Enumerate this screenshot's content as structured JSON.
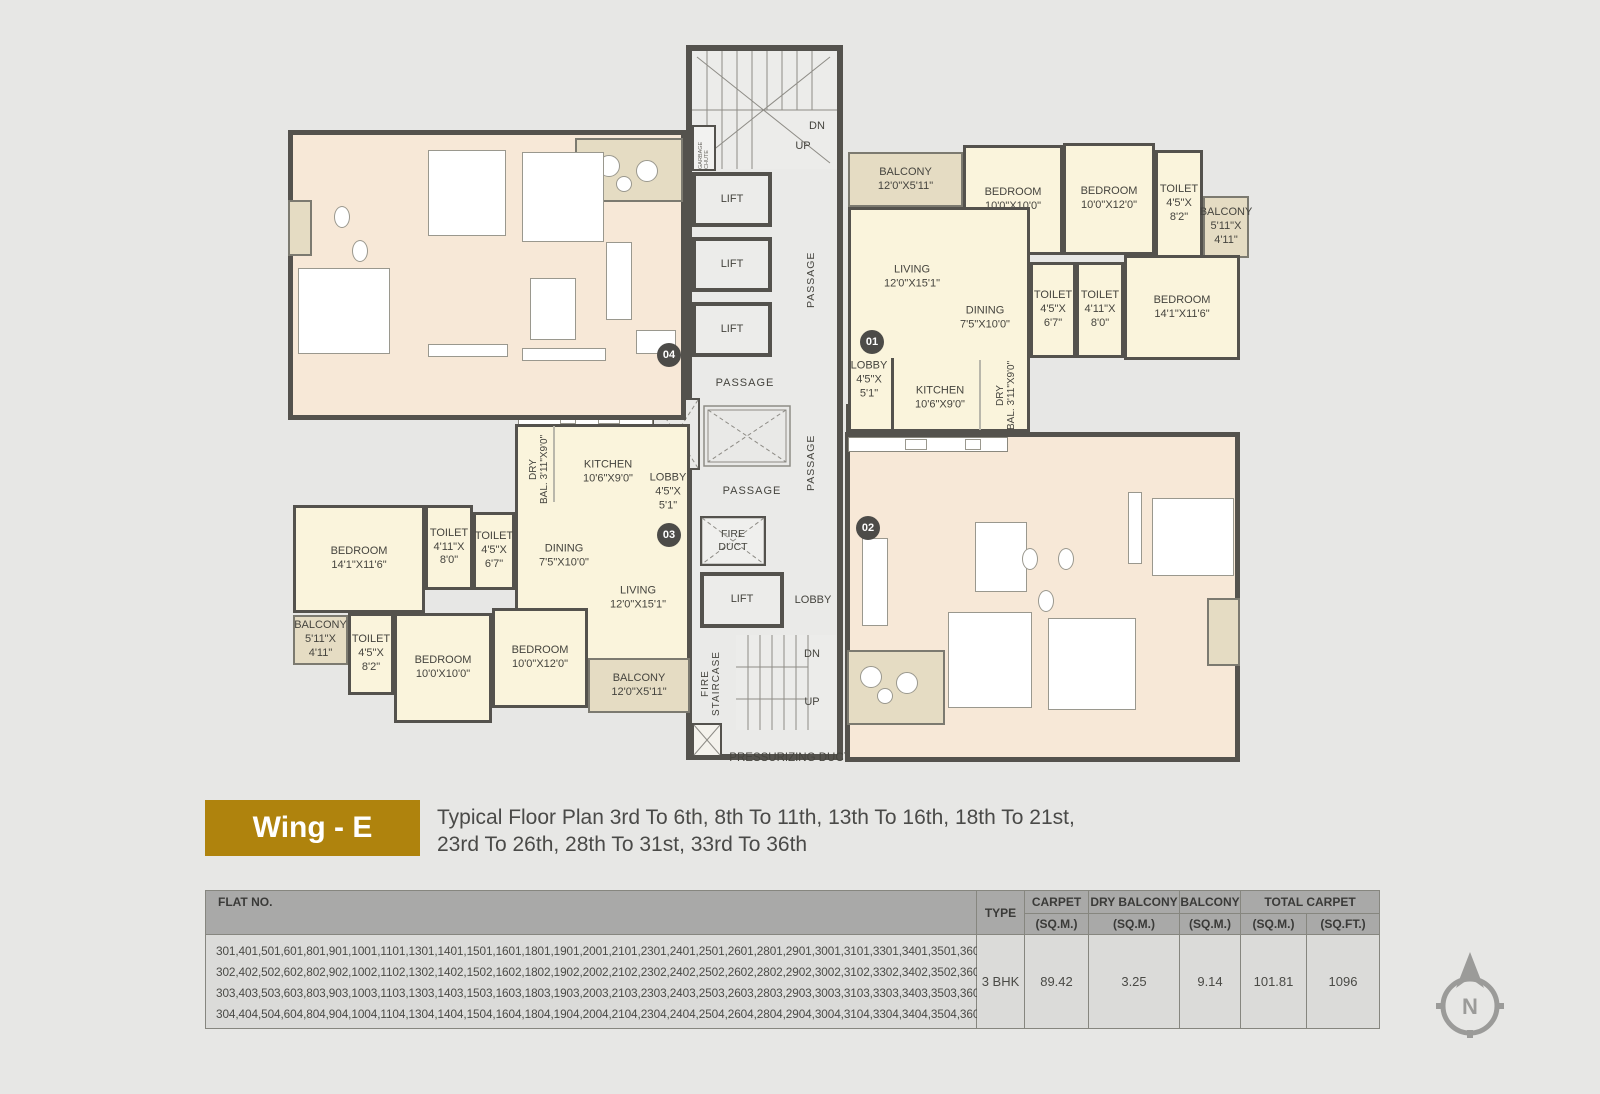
{
  "colors": {
    "accent_gold": "#af830d",
    "room_cream": "#faf4dc",
    "room_peach": "#f7e8d7",
    "balcony_tan": "#e5dcc3",
    "wall_dark": "#54524d",
    "table_header_bg": "#a9a9a8",
    "page_bg": "#e7e7e5"
  },
  "wing": {
    "badge": "Wing - E",
    "title1": "Typical Floor Plan 3rd To 6th, 8th To 11th, 13th To 16th, 18th To 21st,",
    "title2": "23rd To 26th, 28th To 31st, 33rd To 36th"
  },
  "plan": {
    "core": {
      "lift": "LIFT",
      "passage": "PASSAGE",
      "lobby": "LOBBY",
      "dn": "DN",
      "up": "UP",
      "ele_duct": "ELE. DUCT",
      "fire_duct": "FIRE DUCT",
      "fire_staircase": "FIRE STAIRCASE",
      "garbage_chute": "GARBAGE CHUTE",
      "pressurizing_duct": "PRESSURIZING DUCT"
    },
    "units": {
      "u1": {
        "badge": "01",
        "balcony_top": {
          "name": "BALCONY",
          "dims": "12'0\"X5'11\""
        },
        "bedroom_a": {
          "name": "BEDROOM",
          "dims": "10'0\"X10'0\""
        },
        "bedroom_b": {
          "name": "BEDROOM",
          "dims": "10'0\"X12'0\""
        },
        "toilet_a": {
          "name": "TOILET",
          "dims": "4'5\"X 8'2\""
        },
        "balcony_side": {
          "name": "BALCONY",
          "dims": "5'11\"X 4'11\""
        },
        "bedroom_c": {
          "name": "BEDROOM",
          "dims": "14'1\"X11'6\""
        },
        "toilet_b": {
          "name": "TOILET",
          "dims": "4'11\"X 8'0\""
        },
        "toilet_c": {
          "name": "TOILET",
          "dims": "4'5\"X 6'7\""
        },
        "living": {
          "name": "LIVING",
          "dims": "12'0\"X15'1\""
        },
        "dining": {
          "name": "DINING",
          "dims": "7'5\"X10'0\""
        },
        "lobby": {
          "name": "LOBBY",
          "dims": "4'5\"X 5'1\""
        },
        "kitchen": {
          "name": "KITCHEN",
          "dims": "10'6\"X9'0\""
        },
        "dry_balcony": {
          "name": "DRY BAL.",
          "dims": "3'11\"X9'0\""
        }
      },
      "u2": {
        "badge": "02"
      },
      "u3": {
        "badge": "03",
        "balcony_top": {
          "name": "BALCONY",
          "dims": "12'0\"X5'11\""
        },
        "bedroom_a": {
          "name": "BEDROOM",
          "dims": "10'0'X10'0\""
        },
        "bedroom_b": {
          "name": "BEDROOM",
          "dims": "10'0\"X12'0\""
        },
        "toilet_a": {
          "name": "TOILET",
          "dims": "4'5\"X 8'2\""
        },
        "balcony_side": {
          "name": "BALCONY",
          "dims": "5'11\"X 4'11\""
        },
        "bedroom_c": {
          "name": "BEDROOM",
          "dims": "14'1\"X11'6\""
        },
        "toilet_b": {
          "name": "TOILET",
          "dims": "4'11\"X 8'0\""
        },
        "toilet_c": {
          "name": "TOILET",
          "dims": "4'5\"X 6'7\""
        },
        "living": {
          "name": "LIVING",
          "dims": "12'0\"X15'1\""
        },
        "dining": {
          "name": "DINING",
          "dims": "7'5\"X10'0\""
        },
        "lobby": {
          "name": "LOBBY",
          "dims": "4'5\"X 5'1\""
        },
        "kitchen": {
          "name": "KITCHEN",
          "dims": "10'6\"X9'0\""
        },
        "dry_balcony": {
          "name": "DRY BAL.",
          "dims": "3'11\"X9'0\""
        }
      },
      "u4": {
        "badge": "04"
      }
    }
  },
  "table": {
    "header": {
      "flat_no": "FLAT NO.",
      "type": "TYPE",
      "carpet": "CARPET",
      "dry_balcony": "DRY BALCONY",
      "balcony": "BALCONY",
      "total_carpet": "TOTAL CARPET",
      "sqm": "(SQ.M.)",
      "sqft": "(SQ.FT.)"
    },
    "row": {
      "flats_line1": "301,401,501,601,801,901,1001,1101,1301,1401,1501,1601,1801,1901,2001,2101,2301,2401,2501,2601,2801,2901,3001,3101,3301,3401,3501,3601",
      "flats_line2": "302,402,502,602,802,902,1002,1102,1302,1402,1502,1602,1802,1902,2002,2102,2302,2402,2502,2602,2802,2902,3002,3102,3302,3402,3502,3602",
      "flats_line3": "303,403,503,603,803,903,1003,1103,1303,1403,1503,1603,1803,1903,2003,2103,2303,2403,2503,2603,2803,2903,3003,3103,3303,3403,3503,3603",
      "flats_line4": "304,404,504,604,804,904,1004,1104,1304,1404,1504,1604,1804,1904,2004,2104,2304,2404,2504,2604,2804,2904,3004,3104,3304,3404,3504,3604.",
      "type": "3 BHK",
      "carpet_sqm": "89.42",
      "dry_balcony_sqm": "3.25",
      "balcony_sqm": "9.14",
      "total_sqm": "101.81",
      "total_sqft": "1096"
    }
  },
  "compass": {
    "n": "N"
  }
}
